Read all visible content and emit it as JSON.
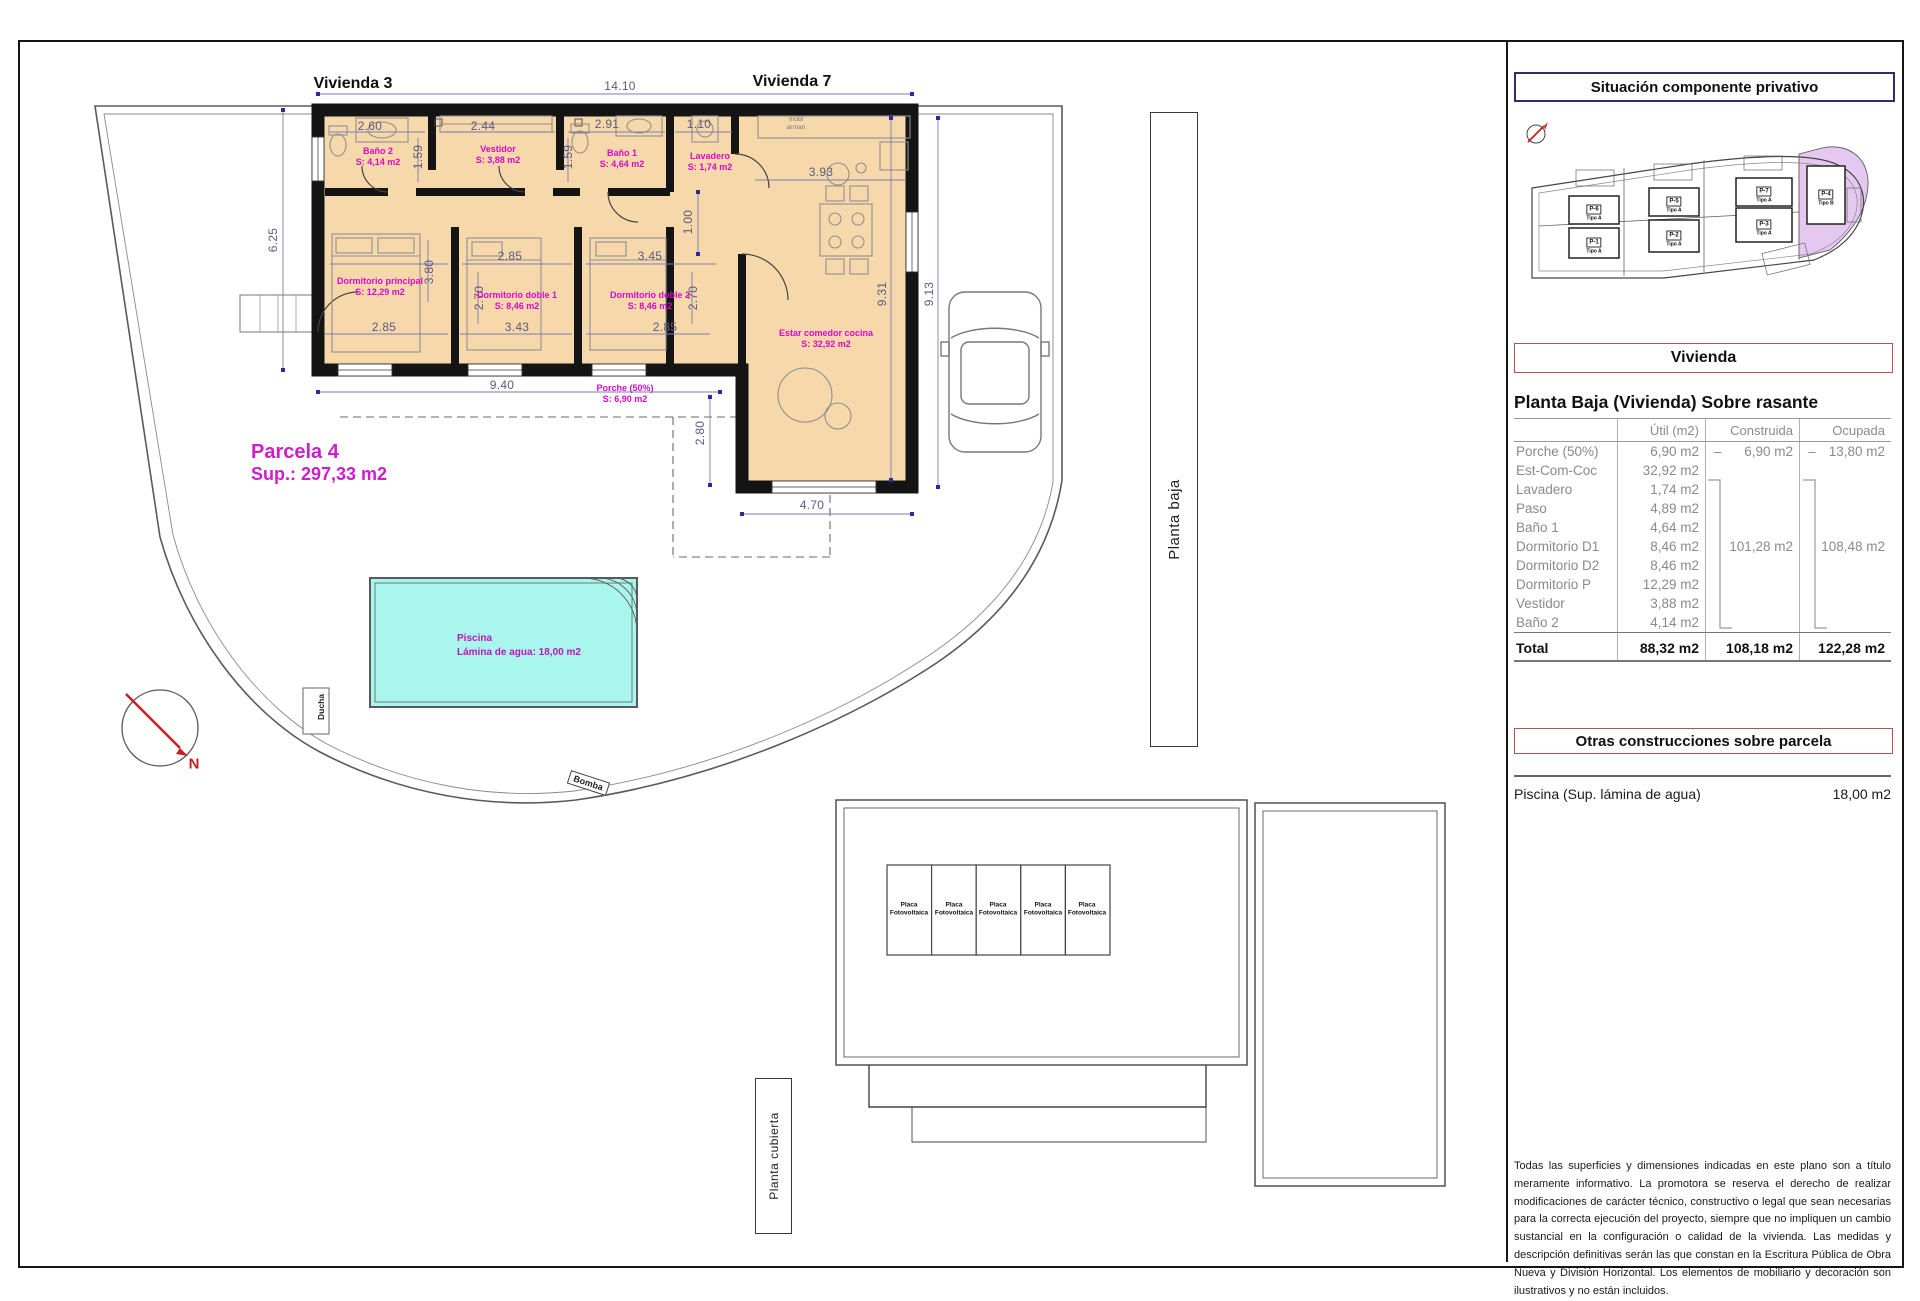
{
  "plan": {
    "vivienda3_label": "Vivienda 3",
    "vivienda7_label": "Vivienda 7",
    "dims": [
      "14.10",
      "6.25",
      "2.60",
      "1.59",
      "2.44",
      "1.59",
      "2.91",
      "1.10",
      "3.93",
      "1.00",
      "9.31",
      "9.13",
      "3.80",
      "2.85",
      "3.45",
      "2.70",
      "2.70",
      "2.85",
      "3.43",
      "2.85",
      "9.40",
      "2.80",
      "4.70"
    ],
    "rooms": [
      {
        "name": "Baño 2",
        "area": "S: 4,14 m2"
      },
      {
        "name": "Vestidor",
        "area": "S: 3,88 m2"
      },
      {
        "name": "Baño 1",
        "area": "S: 4,64 m2"
      },
      {
        "name": "Lavadero",
        "area": "S: 1,74 m2"
      },
      {
        "name": "Dormitorio principal",
        "area": "S: 12,29 m2"
      },
      {
        "name": "Dormitorio doble 1",
        "area": "S: 8,46 m2"
      },
      {
        "name": "Dormitorio doble 2",
        "area": "S: 8,46 m2"
      },
      {
        "name": "Estar comedor cocina",
        "area": "S: 32,92 m2"
      },
      {
        "name": "Porche (50%)",
        "area": "S: 6,90 m2"
      }
    ],
    "parcel": {
      "name": "Parcela 4",
      "sup": "Sup.: 297,33 m2"
    },
    "pool": {
      "line1": "Piscina",
      "line2": "Lámina de agua: 18,00 m2"
    },
    "labels": {
      "planta_baja": "Planta baja",
      "planta_cubierta": "Planta cubierta",
      "bomba": "Bomba",
      "ducha": "Ducha",
      "north": "N",
      "closet_note_l1": "mobl",
      "closet_note_l2": "armari"
    },
    "solar_panel": {
      "l1": "Placa",
      "l2": "Fotovoltaica"
    }
  },
  "sidebar": {
    "situacion_title": "Situación componente privativo",
    "plots": [
      {
        "id": "P-6",
        "tipo": "Tipo A"
      },
      {
        "id": "P-1",
        "tipo": "Tipo A"
      },
      {
        "id": "P-5",
        "tipo": "Tipo A"
      },
      {
        "id": "P-2",
        "tipo": "Tipo A"
      },
      {
        "id": "P-7",
        "tipo": "Tipo A"
      },
      {
        "id": "P-3",
        "tipo": "Tipo A"
      },
      {
        "id": "P-4",
        "tipo": "Tipo B"
      }
    ],
    "vivienda_title": "Vivienda",
    "planta_heading": "Planta Baja (Vivienda) Sobre rasante",
    "table": {
      "columns": [
        "Útil (m2)",
        "Construida (m2)",
        "Ocupada (m2)"
      ],
      "rows": [
        {
          "name": "Porche (50%)",
          "util": "6,90 m2",
          "dash": "–",
          "construida": "6,90 m2",
          "ocupada": "13,80 m2"
        },
        {
          "name": "Est-Com-Coc",
          "util": "32,92 m2"
        },
        {
          "name": "Lavadero",
          "util": "1,74 m2"
        },
        {
          "name": "Paso",
          "util": "4,89 m2"
        },
        {
          "name": "Baño 1",
          "util": "4,64 m2"
        },
        {
          "name": "Dormitorio D1",
          "util": "8,46 m2",
          "construida": "101,28 m2",
          "ocupada": "108,48 m2"
        },
        {
          "name": "Dormitorio D2",
          "util": "8,46 m2"
        },
        {
          "name": "Dormitorio P",
          "util": "12,29 m2"
        },
        {
          "name": "Vestidor",
          "util": "3,88 m2"
        },
        {
          "name": "Baño 2",
          "util": "4,14 m2"
        }
      ],
      "total": {
        "name": "Total",
        "util": "88,32 m2",
        "construida": "108,18 m2",
        "ocupada": "122,28 m2"
      }
    },
    "otras_title": "Otras construcciones sobre parcela",
    "piscina_row": {
      "label": "Piscina (Sup. lámina de agua)",
      "value": "18,00 m2"
    },
    "disclaimer": "Todas las superficies y dimensiones indicadas en este plano son a título meramente informativo. La promotora se reserva el derecho de realizar modificaciones de carácter técnico, constructivo o legal que sean necesarias para la correcta ejecución del proyecto, siempre que no impliquen un cambio sustancial en la configuración o calidad de la vivienda. Las medidas y descripción definitivas serán las que constan en la Escritura Pública de Obra Nueva y División Horizontal. Los elementos de mobiliario y decoración son ilustrativos y no están incluidos."
  },
  "colors": {
    "room_fill": "#f6d8ab",
    "magenta": "#d908c9",
    "pool_fill": "#a9f6ee",
    "lilac_plot": "#e4c8ef",
    "navy_border": "#2e2e6e",
    "red_border": "#b25252",
    "dim_blue": "#5a5a82"
  }
}
